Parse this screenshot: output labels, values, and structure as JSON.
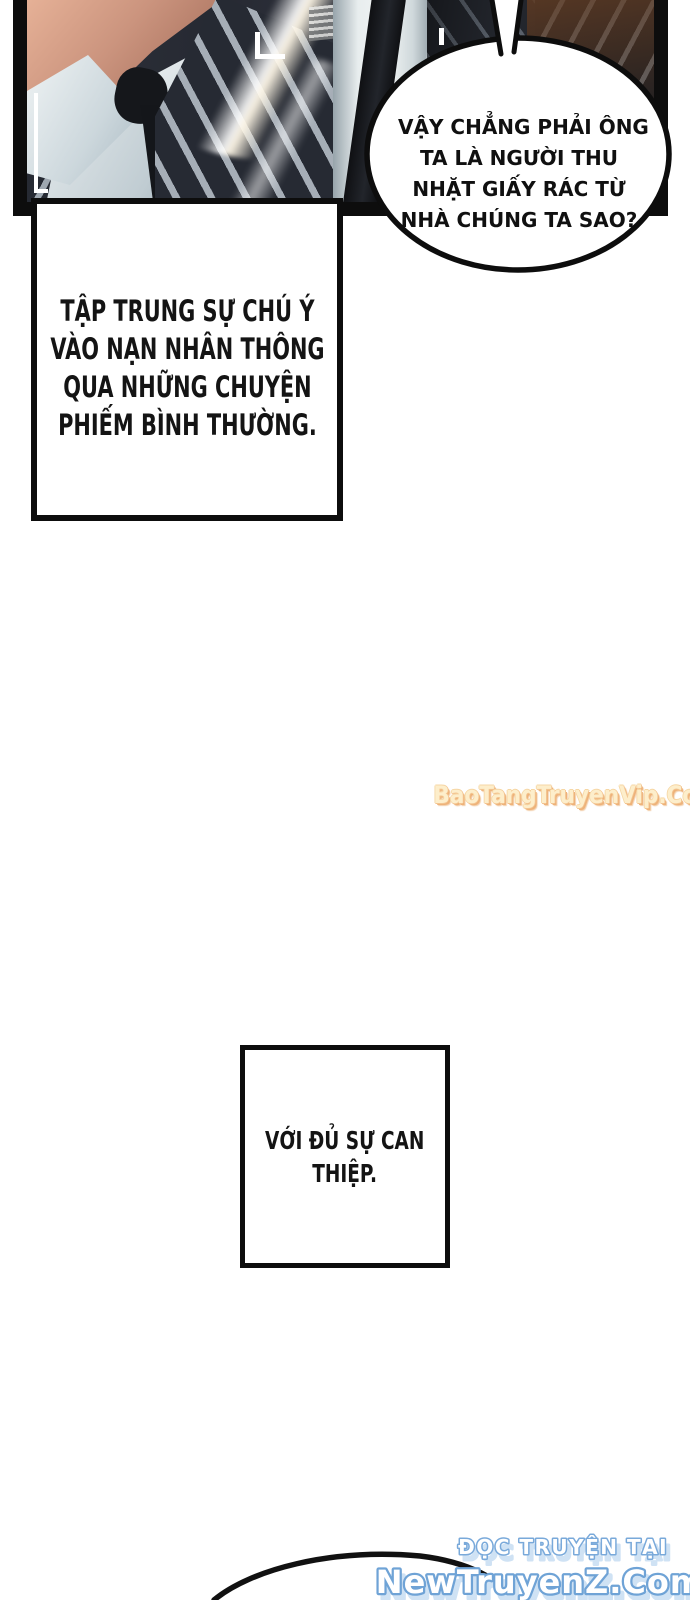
{
  "page": {
    "width": 690,
    "height": 1600,
    "background": "#ffffff"
  },
  "panel": {
    "description": "men in pinstriped suits with white shirts and dark ties, lens flare, camera viewfinder brackets"
  },
  "speech_bubble": {
    "lines": [
      "VẬY CHẲNG PHẢI ÔNG",
      "TA LÀ NGƯỜI THU",
      "NHẶT GIẤY RÁC TỪ",
      "NHÀ CHÚNG TA SAO?"
    ]
  },
  "narration_box_1": {
    "lines": [
      "TẬP TRUNG SỰ CHÚ Ý",
      "VÀO NẠN NHÂN THÔNG",
      "QUA NHỮNG CHUYỆN",
      "PHIẾM BÌNH THƯỜNG."
    ]
  },
  "narration_box_2": {
    "lines": [
      "VỚI ĐỦ SỰ CAN",
      "THIỆP."
    ]
  },
  "watermark": {
    "text": "BaoTangTruyenVip.Com"
  },
  "footer": {
    "tagline": "ĐỌC TRUYỆN TẠI",
    "site": "NewTruyenZ.Com"
  },
  "colors": {
    "ink": "#0d0d0d",
    "watermark_fill": "#fdeecb",
    "watermark_outline": "#f0b77e",
    "footer_fill": "#ffffff",
    "footer_outline": "#6fa3d6",
    "footer_shadow": "#cfe2f4"
  }
}
